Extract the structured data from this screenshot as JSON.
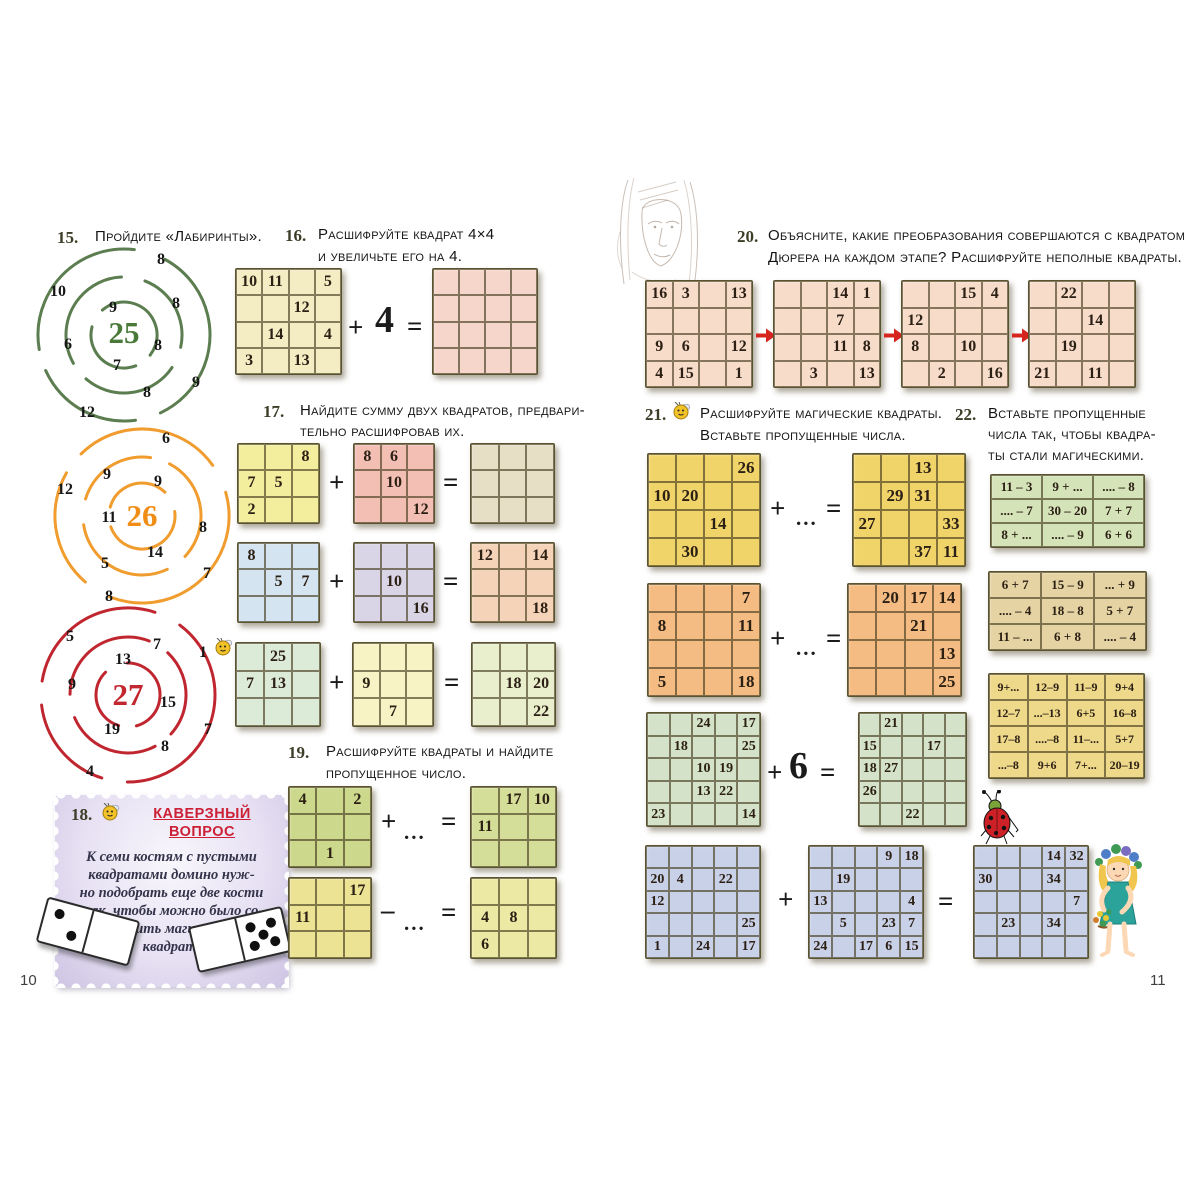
{
  "pages": {
    "left": {
      "page_number": "10",
      "task15": {
        "number": "15.",
        "text": "Пройдите «Лабиринты».",
        "spiral25": {
          "center": "25",
          "numbers": [
            "8",
            "10",
            "9",
            "8",
            "6",
            "8",
            "7",
            "8",
            "9",
            "12"
          ]
        },
        "spiral26": {
          "center": "26",
          "numbers": [
            "6",
            "9",
            "12",
            "9",
            "11",
            "8",
            "14",
            "5",
            "7",
            "8"
          ]
        },
        "spiral27": {
          "center": "27",
          "numbers": [
            "5",
            "7",
            "1",
            "13",
            "9",
            "15",
            "19",
            "7",
            "8",
            "4"
          ]
        }
      },
      "task16": {
        "number": "16.",
        "text_line1": "Расшифруйте квадрат 4×4",
        "text_line2": "и увеличьте его на 4.",
        "plus": "+",
        "operand": "4",
        "equals": "=",
        "source_grid": {
          "color": "#f4ecc3",
          "cells": [
            [
              "10",
              "11",
              "",
              "5"
            ],
            [
              "",
              "",
              "12",
              ""
            ],
            [
              "",
              "14",
              "",
              "4"
            ],
            [
              "3",
              "",
              "13",
              ""
            ]
          ]
        },
        "result_grid": {
          "color": "#f6d6ca",
          "cells": [
            [
              "",
              "",
              "",
              ""
            ],
            [
              "",
              "",
              "",
              ""
            ],
            [
              "",
              "",
              "",
              ""
            ],
            [
              "",
              "",
              "",
              ""
            ]
          ]
        }
      },
      "task17": {
        "number": "17.",
        "text_line1": "Найдите сумму двух квадратов, предвари-",
        "text_line2": "тельно расшифровав их.",
        "row1": {
          "plus": "+",
          "equals": "=",
          "a": {
            "color": "#f2ee9e",
            "cells": [
              [
                "",
                "",
                "8"
              ],
              [
                "7",
                "5",
                ""
              ],
              [
                "2",
                "",
                ""
              ]
            ]
          },
          "b": {
            "color": "#f3bfb4",
            "cells": [
              [
                "8",
                "6",
                ""
              ],
              [
                "",
                "10",
                ""
              ],
              [
                "",
                "",
                "12"
              ]
            ]
          },
          "c": {
            "color": "#e6dfc6",
            "cells": [
              [
                "",
                "",
                ""
              ],
              [
                "",
                "",
                ""
              ],
              [
                "",
                "",
                ""
              ]
            ]
          }
        },
        "row2": {
          "plus": "+",
          "equals": "=",
          "a": {
            "color": "#d4e4f0",
            "cells": [
              [
                "8",
                "",
                ""
              ],
              [
                "",
                "5",
                "7"
              ],
              [
                "",
                "",
                ""
              ]
            ]
          },
          "b": {
            "color": "#d9d4e6",
            "cells": [
              [
                "",
                "",
                ""
              ],
              [
                "",
                "10",
                ""
              ],
              [
                "",
                "",
                "16"
              ]
            ]
          },
          "c": {
            "color": "#f5d3b8",
            "cells": [
              [
                "12",
                "",
                "14"
              ],
              [
                "",
                "",
                ""
              ],
              [
                "",
                "",
                "18"
              ]
            ]
          }
        },
        "row3": {
          "plus": "+",
          "equals": "=",
          "a": {
            "color": "#dcead8",
            "cells": [
              [
                "",
                "25",
                ""
              ],
              [
                "7",
                "13",
                ""
              ],
              [
                "",
                "",
                ""
              ]
            ]
          },
          "b": {
            "color": "#f7f3c4",
            "cells": [
              [
                "",
                "",
                ""
              ],
              [
                "9",
                "",
                ""
              ],
              [
                "",
                "7",
                ""
              ]
            ]
          },
          "c": {
            "color": "#e9efcd",
            "cells": [
              [
                "",
                "",
                ""
              ],
              [
                "",
                "18",
                "20"
              ],
              [
                "",
                "",
                "22"
              ]
            ]
          }
        }
      },
      "task18": {
        "number": "18.",
        "title_line1": "КАВЕРЗНЫЙ",
        "title_line2": "ВОПРОС",
        "body_lines": [
          "К семи костям с пустыми",
          "квадратами домино нуж-",
          "но подобрать еще две кости",
          "так, чтобы можно было со-",
          "ставить магический",
          "квадрат."
        ],
        "dominoes": [
          {
            "left_pips": 2,
            "right_pips": 0
          },
          {
            "left_pips": 0,
            "right_pips": 5
          }
        ]
      },
      "task19": {
        "number": "19.",
        "text_line1": "Расшифруйте квадраты и найдите",
        "text_line2": "пропущенное число.",
        "row1": {
          "plus": "+",
          "dots": "...",
          "equals": "=",
          "a": {
            "color": "#ccd98c",
            "cells": [
              [
                "4",
                "",
                "2"
              ],
              [
                "",
                "",
                ""
              ],
              [
                "",
                "1",
                ""
              ]
            ]
          },
          "b": {
            "color": "#d4de98",
            "cells": [
              [
                "",
                "17",
                "10"
              ],
              [
                "11",
                "",
                ""
              ],
              [
                "",
                "",
                ""
              ]
            ]
          }
        },
        "row2": {
          "minus": "–",
          "dots": "...",
          "equals": "=",
          "a": {
            "color": "#ece394",
            "cells": [
              [
                "",
                "",
                "17"
              ],
              [
                "11",
                "",
                ""
              ],
              [
                "",
                "",
                ""
              ]
            ]
          },
          "b": {
            "color": "#ece9a4",
            "cells": [
              [
                "",
                "",
                ""
              ],
              [
                "4",
                "8",
                ""
              ],
              [
                "6",
                "",
                ""
              ]
            ]
          }
        }
      }
    },
    "right": {
      "page_number": "11",
      "task20": {
        "number": "20.",
        "text_line1": "Объясните, какие преобразования совершаются с квадратом",
        "text_line2": "Дюрера на каждом этапе? Расшифруйте неполные квадраты.",
        "grid1": {
          "color": "#f8dcca",
          "cells": [
            [
              "16",
              "3",
              "",
              "13"
            ],
            [
              "",
              "",
              "",
              ""
            ],
            [
              "9",
              "6",
              "",
              "12"
            ],
            [
              "4",
              "15",
              "",
              "1"
            ]
          ]
        },
        "grid2": {
          "color": "#f8dcca",
          "cells": [
            [
              "",
              "",
              "14",
              "1"
            ],
            [
              "",
              "",
              "7",
              ""
            ],
            [
              "",
              "",
              "11",
              "8"
            ],
            [
              "",
              "3",
              "",
              "13"
            ]
          ]
        },
        "grid3": {
          "color": "#f8dcca",
          "cells": [
            [
              "",
              "",
              "15",
              "4"
            ],
            [
              "12",
              "",
              "",
              ""
            ],
            [
              "8",
              "",
              "10",
              ""
            ],
            [
              "",
              "2",
              "",
              "16"
            ]
          ]
        },
        "grid4": {
          "color": "#f8dcca",
          "cells": [
            [
              "",
              "22",
              "",
              ""
            ],
            [
              "",
              "",
              "14",
              ""
            ],
            [
              "",
              "19",
              "",
              ""
            ],
            [
              "21",
              "",
              "11",
              ""
            ]
          ]
        }
      },
      "task21": {
        "number": "21.",
        "text_line1": "Расшифруйте магические квадраты.",
        "text_line2": "Вставьте пропущенные числа.",
        "row1": {
          "plus": "+",
          "dots": "...",
          "equals": "=",
          "a": {
            "color": "#f1d469",
            "cells": [
              [
                "",
                "",
                "",
                "26"
              ],
              [
                "10",
                "20",
                "",
                ""
              ],
              [
                "",
                "",
                "14",
                ""
              ],
              [
                "",
                "30",
                "",
                ""
              ]
            ]
          },
          "b": {
            "color": "#f1d469",
            "cells": [
              [
                "",
                "",
                "13",
                ""
              ],
              [
                "",
                "29",
                "31",
                ""
              ],
              [
                "27",
                "",
                "",
                "33"
              ],
              [
                "",
                "",
                "37",
                "11"
              ]
            ]
          }
        },
        "row2": {
          "plus": "+",
          "dots": "...",
          "equals": "=",
          "a": {
            "color": "#f4bc82",
            "cells": [
              [
                "",
                "",
                "",
                "7"
              ],
              [
                "8",
                "",
                "",
                "11"
              ],
              [
                "",
                "",
                "",
                ""
              ],
              [
                "5",
                "",
                "",
                "18"
              ]
            ]
          },
          "b": {
            "color": "#f4bc82",
            "cells": [
              [
                "",
                "20",
                "17",
                "14"
              ],
              [
                "",
                "",
                "21",
                ""
              ],
              [
                "",
                "",
                "",
                "13"
              ],
              [
                "",
                "",
                "",
                "25"
              ]
            ]
          }
        },
        "row3": {
          "plus": "+",
          "operand": "6",
          "equals": "=",
          "a": {
            "color": "#d3e2c9",
            "cells": [
              [
                "",
                "",
                "24",
                "",
                "17"
              ],
              [
                "",
                "18",
                "",
                "",
                "25"
              ],
              [
                "",
                "",
                "10",
                "19",
                ""
              ],
              [
                "",
                "",
                "13",
                "22",
                ""
              ],
              [
                "23",
                "",
                "",
                "",
                "14"
              ]
            ]
          },
          "b": {
            "color": "#d3e2c9",
            "cells": [
              [
                "",
                "21",
                "",
                "",
                ""
              ],
              [
                "15",
                "",
                "",
                "17",
                ""
              ],
              [
                "18",
                "27",
                "",
                "",
                ""
              ],
              [
                "26",
                "",
                "",
                "",
                ""
              ],
              [
                "",
                "",
                "22",
                "",
                ""
              ]
            ]
          }
        },
        "row4": {
          "plus": "+",
          "equals": "=",
          "a": {
            "color": "#c9d1e8",
            "cells": [
              [
                "",
                "",
                "",
                "",
                ""
              ],
              [
                "20",
                "4",
                "",
                "22",
                ""
              ],
              [
                "12",
                "",
                "",
                "",
                ""
              ],
              [
                "",
                "",
                "",
                "",
                "25"
              ],
              [
                "1",
                "",
                "24",
                "",
                "17"
              ]
            ]
          },
          "b": {
            "color": "#c9d1e8",
            "cells": [
              [
                "",
                "",
                "",
                "9",
                "18"
              ],
              [
                "",
                "19",
                "",
                "",
                ""
              ],
              [
                "13",
                "",
                "",
                "",
                "4"
              ],
              [
                "",
                "5",
                "",
                "23",
                "7"
              ],
              [
                "24",
                "",
                "17",
                "6",
                "15"
              ]
            ]
          },
          "c": {
            "color": "#c9d1e8",
            "cells": [
              [
                "",
                "",
                "",
                "14",
                "32"
              ],
              [
                "30",
                "",
                "",
                "34",
                ""
              ],
              [
                "",
                "",
                "",
                "",
                "7"
              ],
              [
                "",
                "23",
                "",
                "34",
                ""
              ],
              [
                "",
                "",
                "",
                "",
                ""
              ]
            ]
          }
        }
      },
      "task22": {
        "number": "22.",
        "text_line1": "Вставьте пропущенные",
        "text_line2": "числа так, чтобы квадра-",
        "text_line3": "ты стали магическими.",
        "table1": {
          "color": "#d4e3b8",
          "cells": [
            [
              "11 – 3",
              "9 + ...",
              ".... – 8"
            ],
            [
              ".... – 7",
              "30 – 20",
              "7 + 7"
            ],
            [
              "8 + ...",
              ".... – 9",
              "6 + 6"
            ]
          ]
        },
        "table2": {
          "color": "#e5d3a3",
          "cells": [
            [
              "6 + 7",
              "15 – 9",
              "... + 9"
            ],
            [
              ".... – 4",
              "18 – 8",
              "5 + 7"
            ],
            [
              "11 – ...",
              "6 + 8",
              ".... – 4"
            ]
          ]
        },
        "table3": {
          "color": "#eed88a",
          "cells": [
            [
              "9+...",
              "12–9",
              "11–9",
              "9+4"
            ],
            [
              "12–7",
              "...–13",
              "6+5",
              "16–8"
            ],
            [
              "17–8",
              "....–8",
              "11–...",
              "5+7"
            ],
            [
              "...–8",
              "9+6",
              "7+...",
              "20–19"
            ]
          ]
        }
      }
    }
  },
  "palette": {
    "spiral_green": "#5b7d4f",
    "spiral_orange": "#f09c2e",
    "spiral_red": "#c0262f",
    "arrow_red": "#d6251f",
    "stamp_title_red": "#cc2036"
  }
}
